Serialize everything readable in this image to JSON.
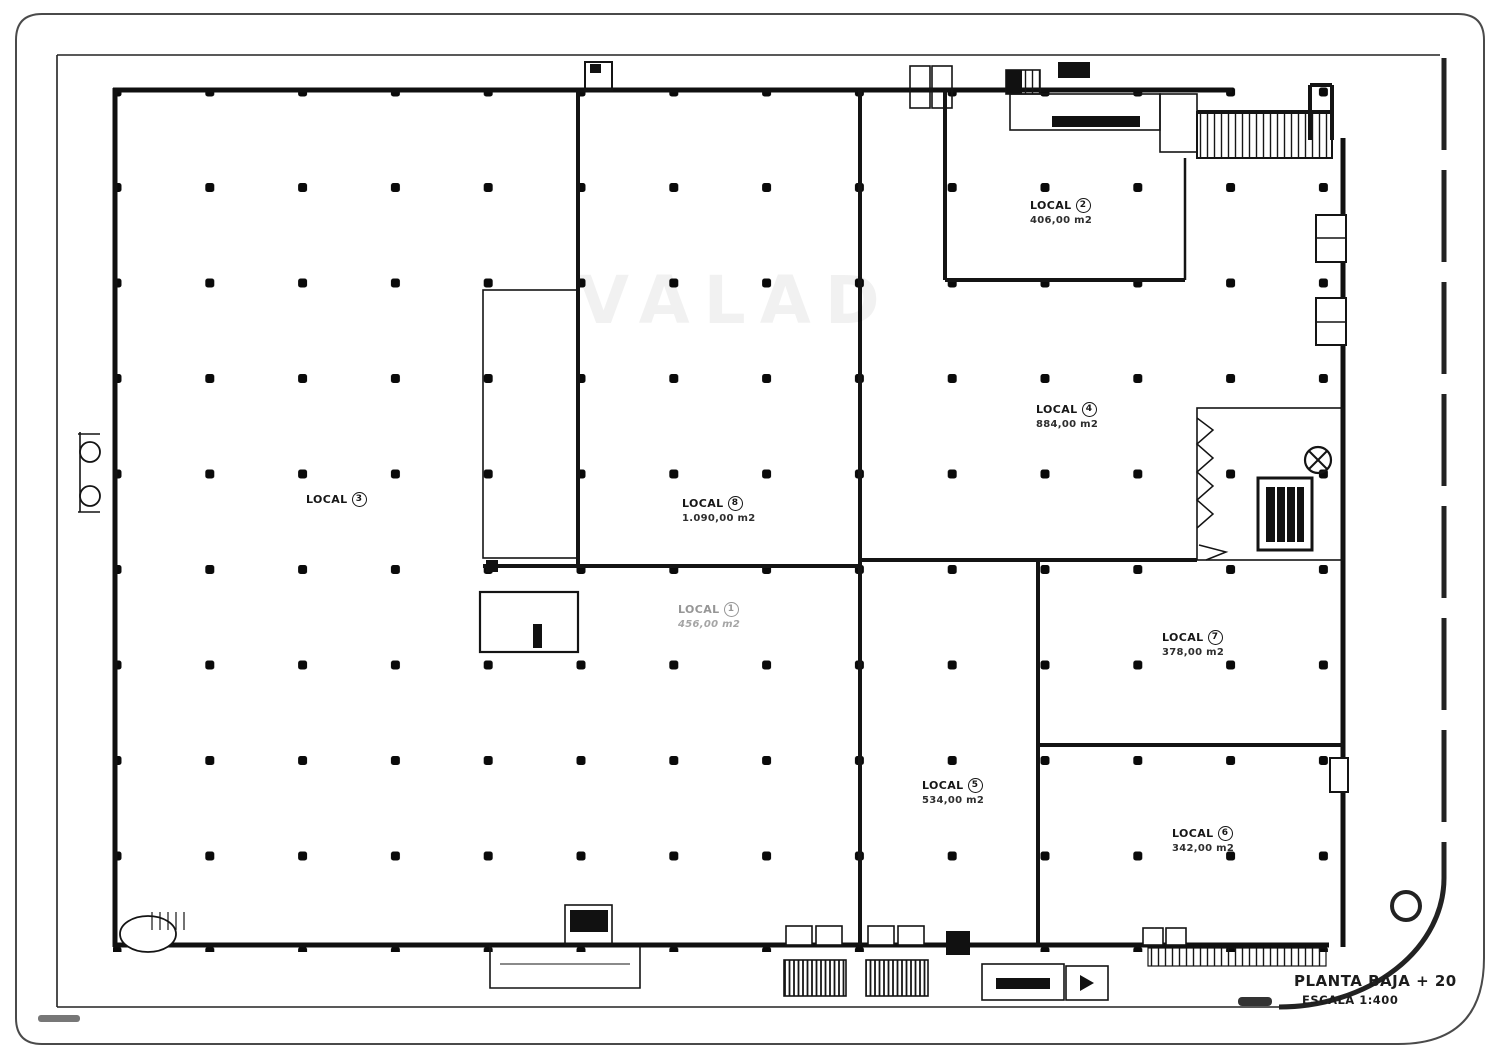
{
  "drawing": {
    "watermark": "VALAD",
    "title": "PLANTA BAJA + 20",
    "scale": "ESCALA 1:400",
    "ink_color": "#111111",
    "muted_label_color": "#969696"
  },
  "locals": [
    {
      "label": "LOCAL",
      "number": "3",
      "area": ""
    },
    {
      "label": "LOCAL",
      "number": "8",
      "area": "1.090,00 m2"
    },
    {
      "label": "LOCAL",
      "number": "1",
      "area": "456,00 m2"
    },
    {
      "label": "LOCAL",
      "number": "2",
      "area": "406,00 m2"
    },
    {
      "label": "LOCAL",
      "number": "4",
      "area": "884,00 m2"
    },
    {
      "label": "LOCAL",
      "number": "7",
      "area": "378,00 m2"
    },
    {
      "label": "LOCAL",
      "number": "5",
      "area": "534,00 m2"
    },
    {
      "label": "LOCAL",
      "number": "6",
      "area": "342,00 m2"
    }
  ]
}
